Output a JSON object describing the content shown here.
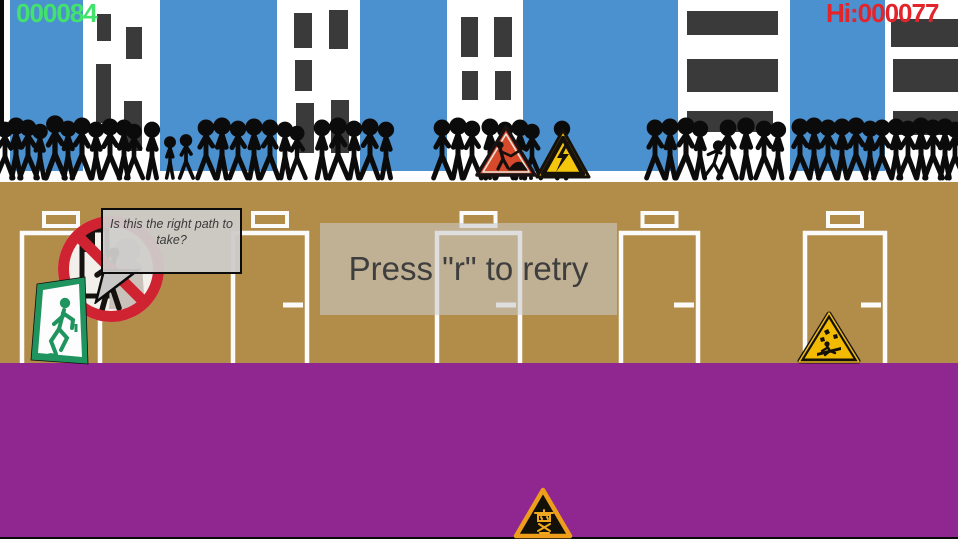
{
  "hud": {
    "score": "000084",
    "hi_score": "Hi:000077",
    "score_color": "#43e26d",
    "hi_score_color": "#e3242a"
  },
  "speech_bubble": {
    "text": "Is this the right path to take?"
  },
  "overlay": {
    "retry_prompt": "Press \"r\" to retry"
  },
  "signs": {
    "construction": "roadworks-warning",
    "electric": "high-voltage-warning",
    "falling_debris": "falling-debris-warning",
    "no_entry": "no-entry-prohibition",
    "exit": "emergency-exit",
    "fog": {
      "name": "fog-warning",
      "glyph": "雾"
    }
  },
  "colors": {
    "sky_blue": "#4b90cf",
    "building_white": "#ffffff",
    "window_gray": "#3a3a3a",
    "wall_tan": "#b28c49",
    "ground_purple": "#90268f",
    "sign_red_orange": "#d7492b",
    "sign_yellow": "#f4c70c",
    "prohibition_red": "#cf2331",
    "exit_green": "#20945f"
  }
}
